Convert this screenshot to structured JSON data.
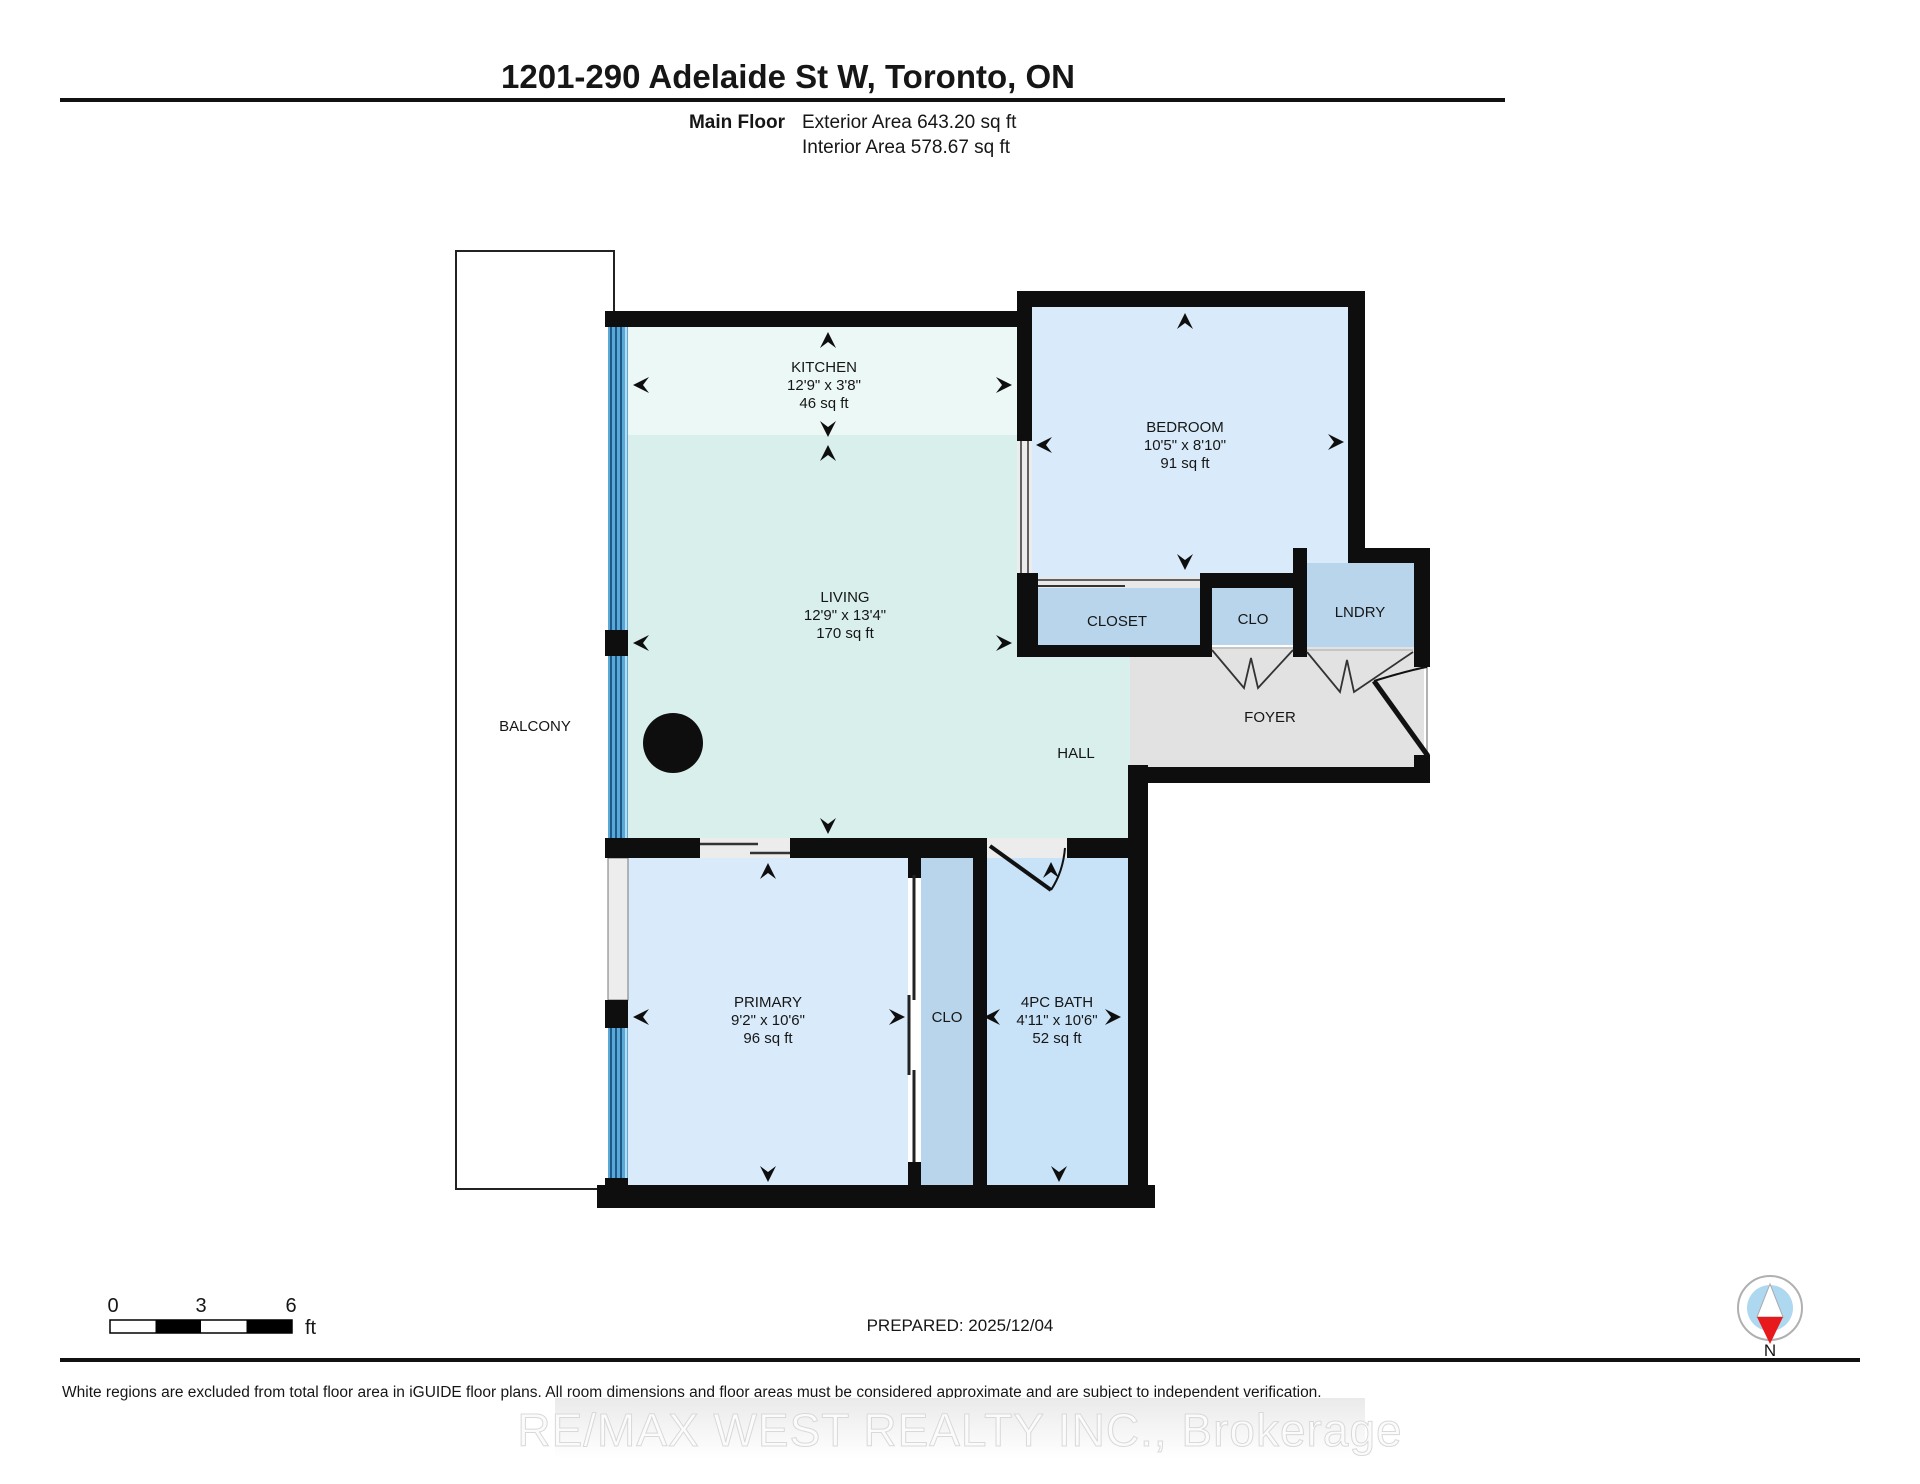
{
  "header": {
    "title": "1201-290 Adelaide St W, Toronto, ON",
    "floor_label": "Main Floor",
    "exterior_area": "Exterior Area 643.20 sq ft",
    "interior_area": "Interior Area 578.67 sq ft"
  },
  "rooms": {
    "kitchen": {
      "name": "KITCHEN",
      "dims": "12'9\" x 3'8\"",
      "area": "46 sq ft"
    },
    "living": {
      "name": "LIVING",
      "dims": "12'9\" x 13'4\"",
      "area": "170 sq ft"
    },
    "bedroom": {
      "name": "BEDROOM",
      "dims": "10'5\" x 8'10\"",
      "area": "91 sq ft"
    },
    "primary": {
      "name": "PRIMARY",
      "dims": "9'2\" x 10'6\"",
      "area": "96 sq ft"
    },
    "bath": {
      "name": "4PC BATH",
      "dims": "4'11\" x 10'6\"",
      "area": "52 sq ft"
    },
    "closet": {
      "name": "CLOSET"
    },
    "clo_hall": {
      "name": "CLO"
    },
    "lndry": {
      "name": "LNDRY"
    },
    "foyer": {
      "name": "FOYER"
    },
    "hall": {
      "name": "HALL"
    },
    "balcony": {
      "name": "BALCONY"
    },
    "clo_primary": {
      "name": "CLO"
    }
  },
  "scale_bar": {
    "tick_0": "0",
    "tick_3": "3",
    "tick_6": "6",
    "unit": "ft"
  },
  "prepared_label": "PREPARED: 2025/12/04",
  "compass": {
    "north_label": "N"
  },
  "disclaimer": "White regions are excluded from total floor area in iGUIDE floor plans. All room dimensions and floor areas must be considered approximate and are subject to independent verification.",
  "watermark": "RE/MAX WEST REALTY INC., Brokerage",
  "colors": {
    "wall": "#0e0e0e",
    "kitchen_fill": "#ecf8f5",
    "living_fill": "#d9efec",
    "bedroom_fill": "#d9ebfa",
    "bath_fill": "#c8e3f8",
    "closet_fill": "#b9d5eb",
    "foyer_fill": "#e2e2e2",
    "window_glass": "#5aa8d8",
    "window_stripe": "#17517e",
    "compass_red": "#e8191c",
    "compass_blue": "#aed7f0"
  }
}
